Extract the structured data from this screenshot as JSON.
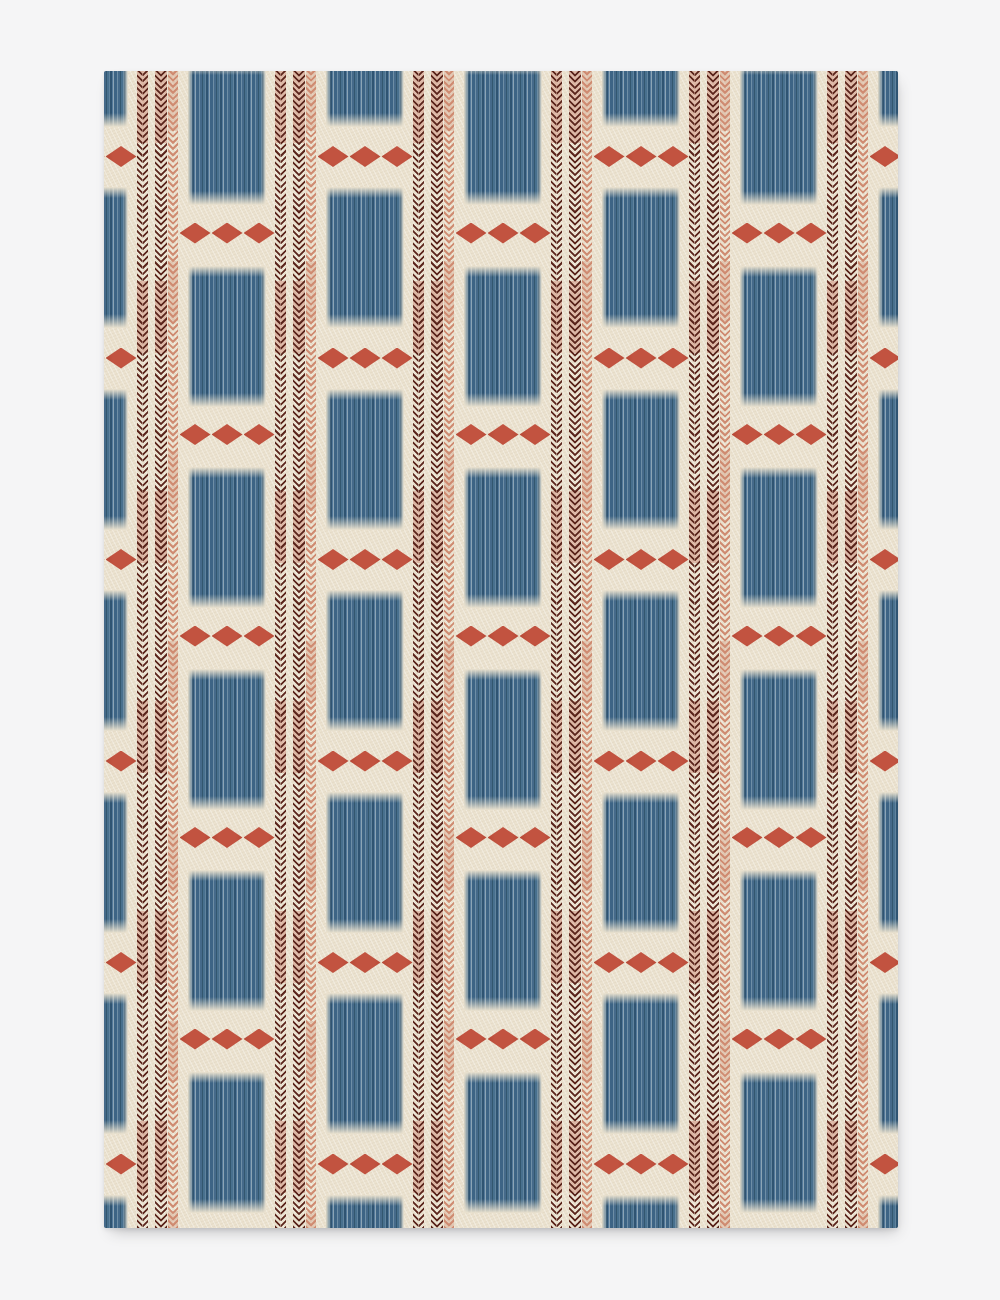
{
  "image_type": "product photo of a patterned flat rug on a plain light-gray backdrop; no text, no UI controls",
  "page": {
    "width": 1000,
    "height": 1300,
    "background_color": "#f5f5f6"
  },
  "rug": {
    "left": 104,
    "top": 71,
    "width": 794,
    "height": 1157,
    "background_color": "#ebe2cf",
    "corner_radius": 2,
    "shadow": "soft drop shadow toward bottom-right"
  },
  "palette": {
    "page_gray": "#f5f5f6",
    "cream": "#ebe2cf",
    "denim_blue": "#456a8a",
    "denim_blue_dark": "#2f5472",
    "denim_blue_light": "#8ba4b5",
    "terracotta": "#b94936",
    "maroon": "#5b251c",
    "salmon": "#cf8b71"
  },
  "pattern": {
    "description": "vertical columns of streaky denim-blue ikat rectangles alternating with rows of three terracotta diamonds; each column followed by two maroon herringbone pinstripes and one salmon herringbone pinstripe; adjacent columns vertically staggered; pattern cropped at rug edges (partial columns at left and right)",
    "unit_period_px": 138,
    "column_x_abs": [
      50,
      188,
      326,
      464,
      602,
      740,
      878
    ],
    "column_phases": [
      2,
      1,
      2,
      1,
      2,
      1,
      2
    ],
    "rect": {
      "width": 78,
      "height": 141,
      "vertical_period": 201.5
    },
    "phase1": {
      "first_rect_top": 64,
      "first_diamond_center_y": 233
    },
    "phase2": {
      "first_rect_top": -14.5,
      "first_diamond_center_y": 156.5
    },
    "stripes": [
      {
        "offset": 87,
        "width": 11,
        "color_key": "maroon"
      },
      {
        "offset": 105,
        "width": 12,
        "color_key": "maroon"
      },
      {
        "offset": 118,
        "width": 10,
        "color_key": "salmon"
      }
    ],
    "diamond": {
      "width": 31,
      "height": 21,
      "spacing": 32,
      "count_per_group": 3
    }
  }
}
